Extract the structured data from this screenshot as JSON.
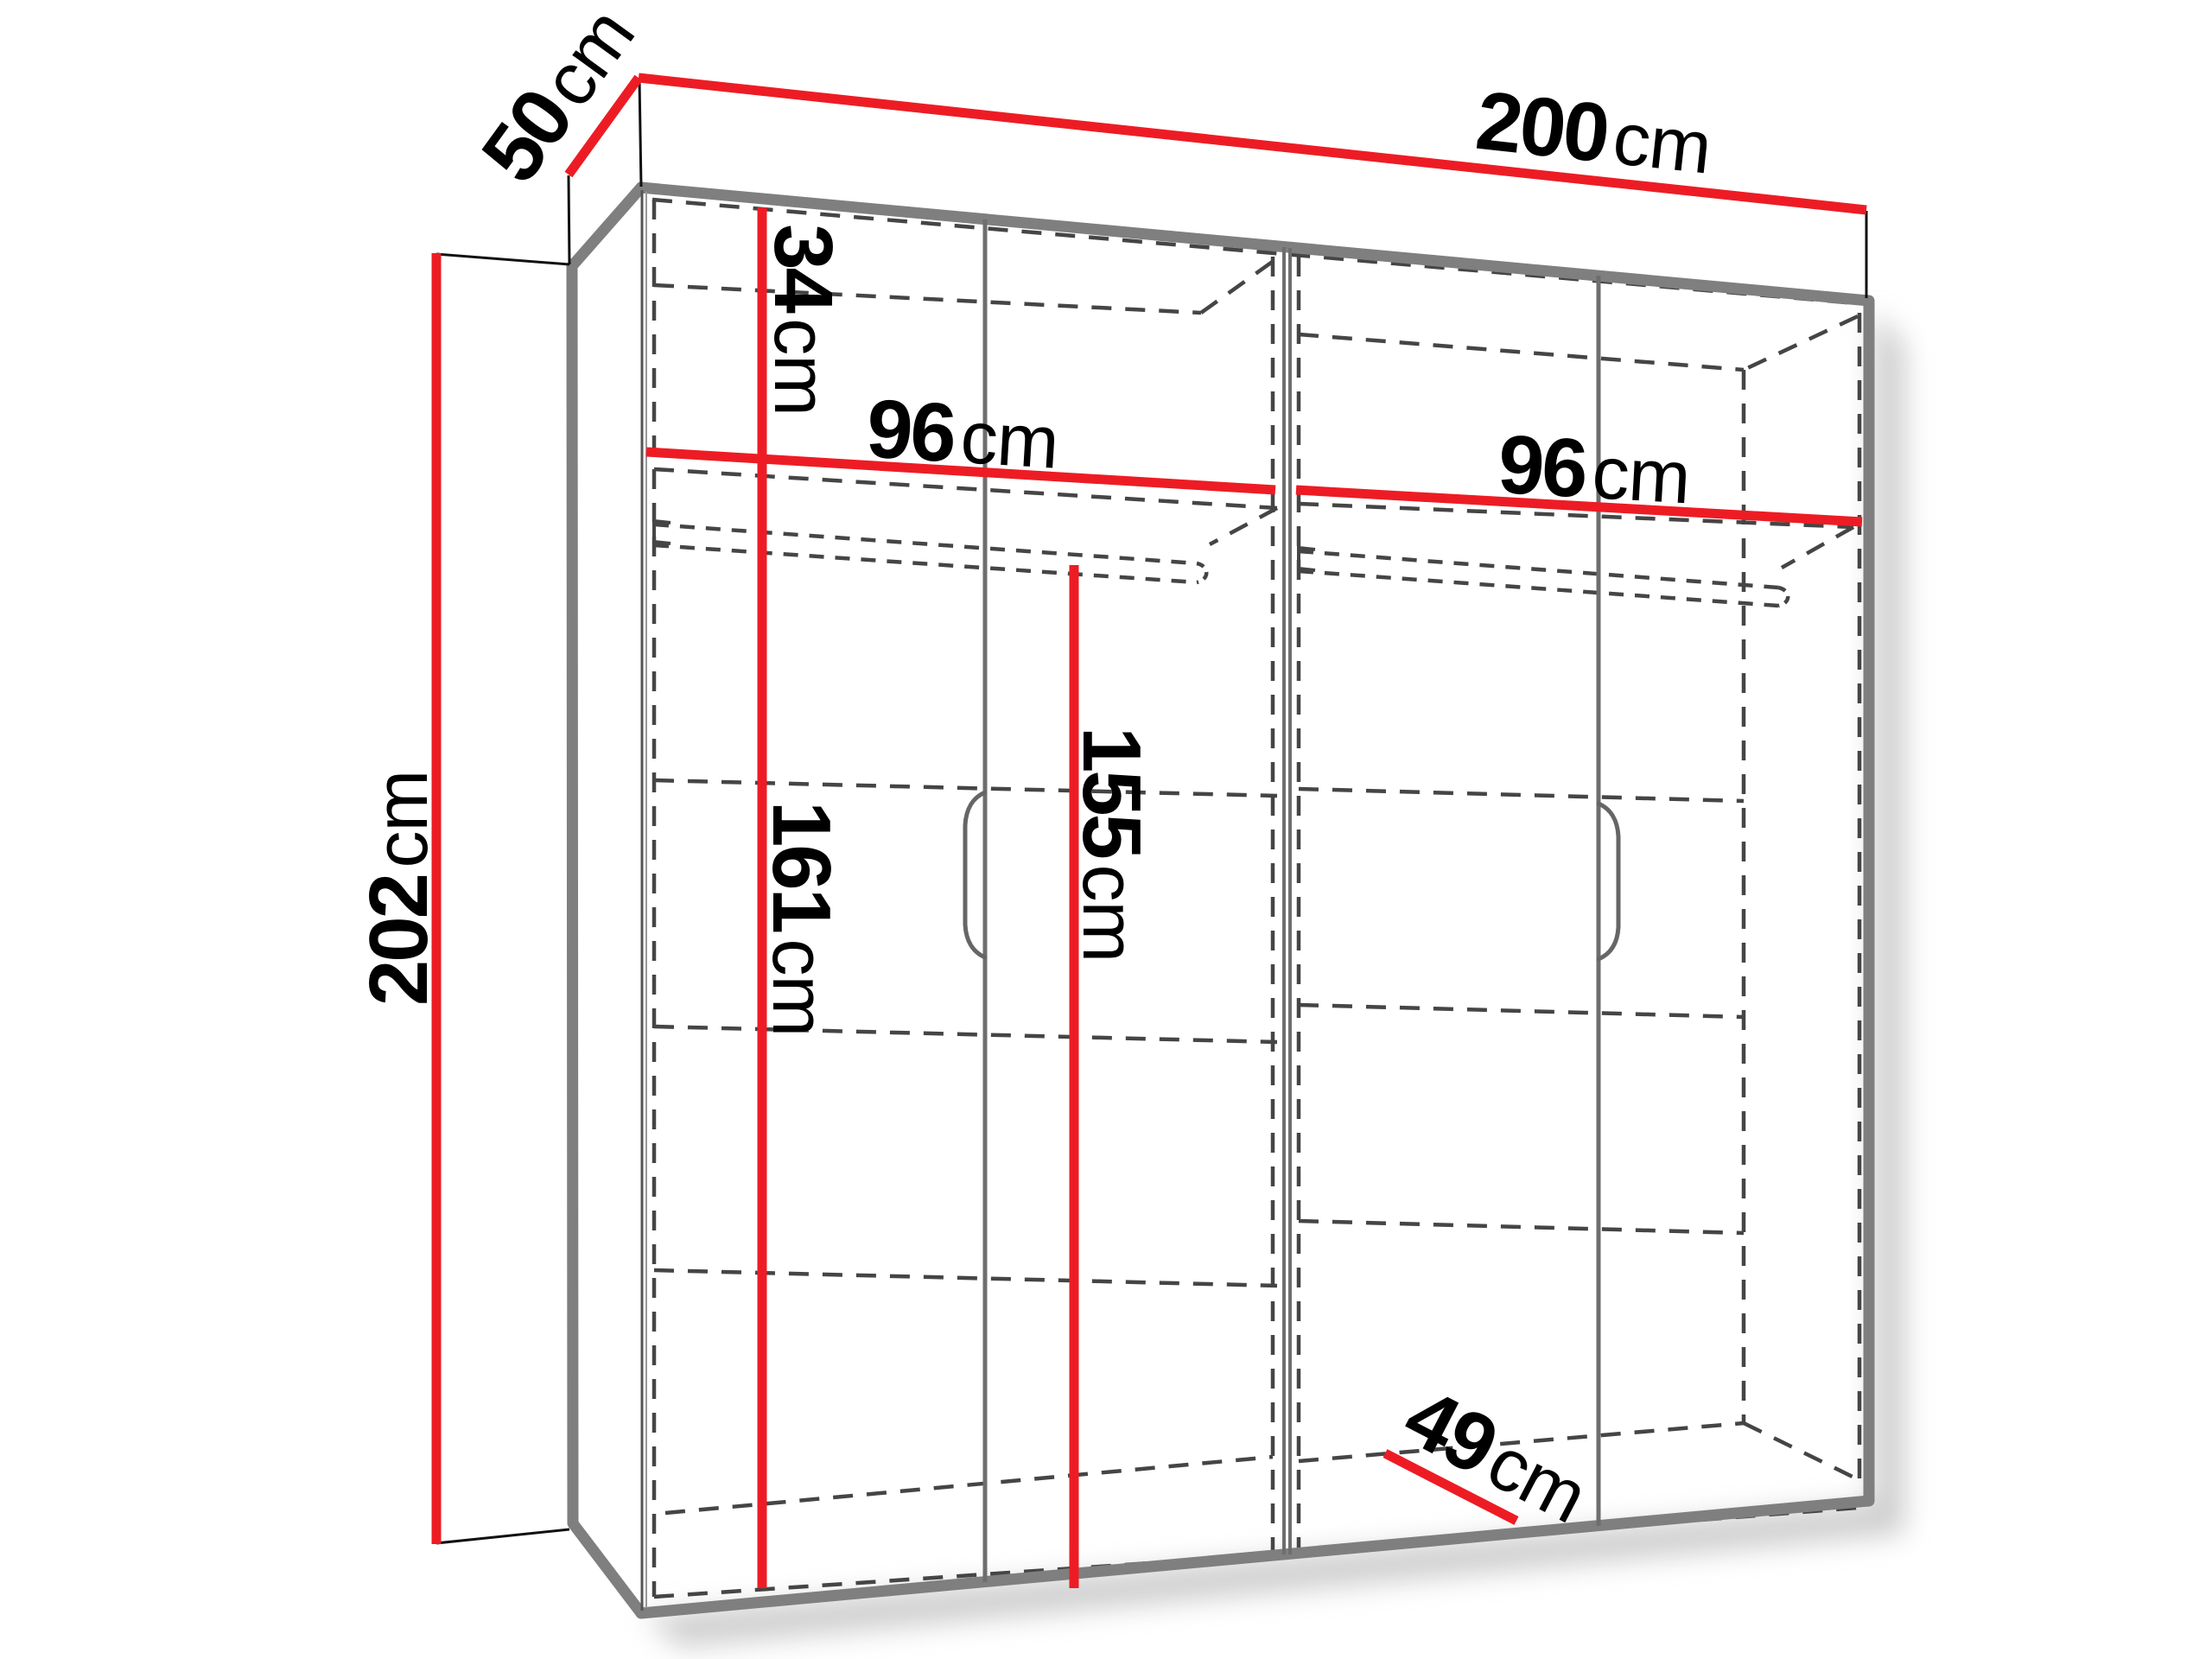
{
  "diagram": {
    "type": "furniture-dimension-diagram",
    "subject": "four-door wardrobe with interior layout",
    "colors": {
      "dimension_line": "#ed1c24",
      "outline": "#7f7f7f",
      "door_line": "#6e6e6e",
      "hidden_line": "#454545",
      "extension_line": "#111111",
      "label_text": "#000000"
    },
    "dims": {
      "width": {
        "value": "200",
        "unit": "cm"
      },
      "depth": {
        "value": "50",
        "unit": "cm"
      },
      "height": {
        "value": "202",
        "unit": "cm"
      },
      "top_shelf": {
        "value": "34",
        "unit": "cm"
      },
      "left_section_width": {
        "value": "96",
        "unit": "cm"
      },
      "right_section_width": {
        "value": "96",
        "unit": "cm"
      },
      "left_interior_height": {
        "value": "161",
        "unit": "cm"
      },
      "hanging_space_height": {
        "value": "155",
        "unit": "cm"
      },
      "interior_depth": {
        "value": "49",
        "unit": "cm"
      }
    }
  }
}
